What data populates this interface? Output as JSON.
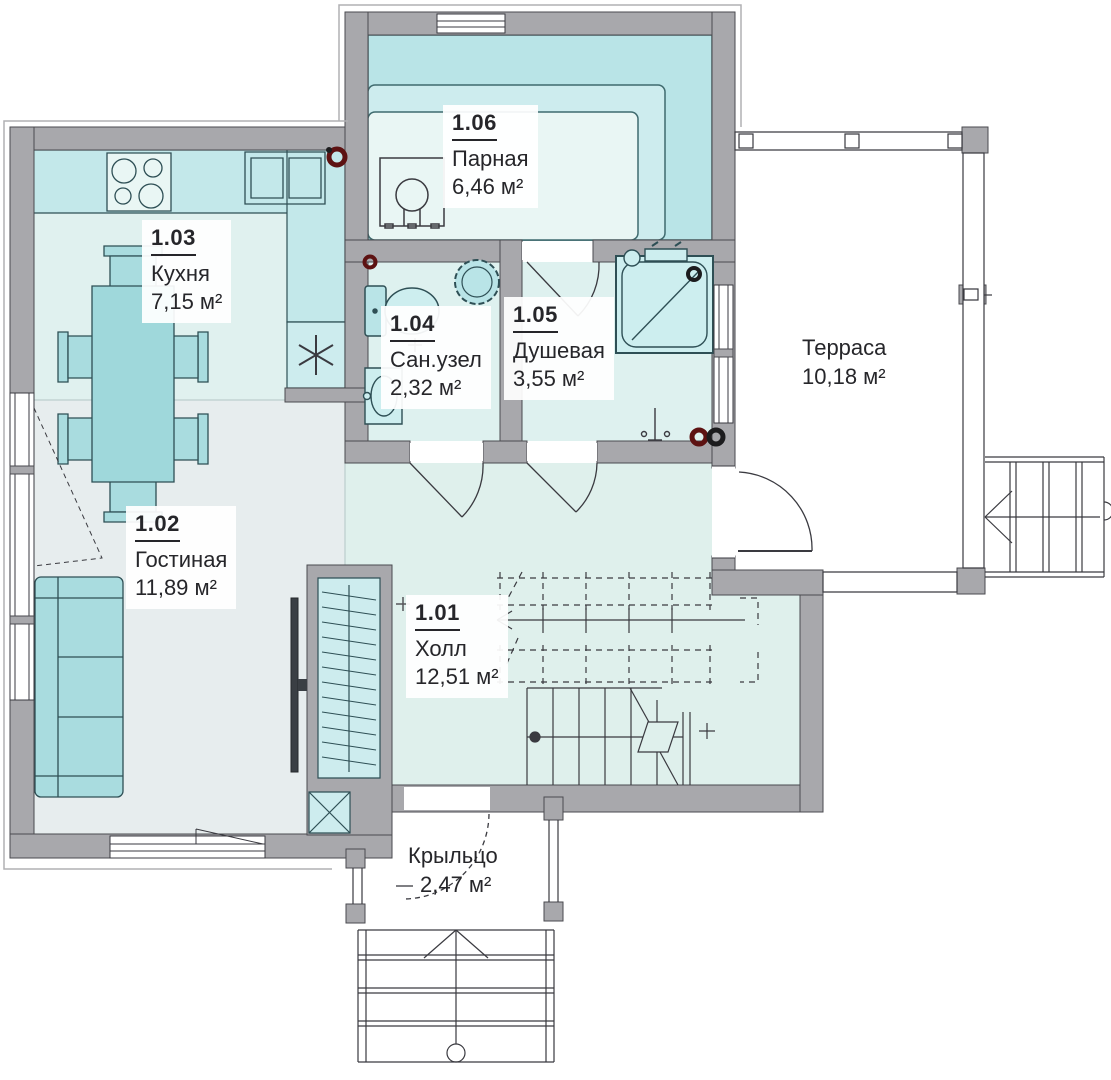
{
  "plan_type": "floor-plan",
  "rooms": [
    {
      "number": "1.06",
      "name": "Парная",
      "area": "6,46 м²"
    },
    {
      "number": "1.03",
      "name": "Кухня",
      "area": "7,15 м²"
    },
    {
      "number": "1.04",
      "name": "Сан.узел",
      "area": "2,32 м²"
    },
    {
      "number": "1.05",
      "name": "Душевая",
      "area": "3,55 м²"
    },
    {
      "number": "1.02",
      "name": "Гостиная",
      "area": "11,89 м²"
    },
    {
      "number": "1.01",
      "name": "Холл",
      "area": "12,51 м²"
    },
    {
      "number": "",
      "name": "Терраса",
      "area": "10,18 м²"
    },
    {
      "number": "",
      "name": "Крыльцо",
      "area": "2,47 м²"
    }
  ],
  "icons": {
    "fridge_star": "snowflake-asterisk",
    "riser_red": "water-riser",
    "riser_black": "sewer-riser",
    "anchor_cross": "plus-mark"
  },
  "colors": {
    "wall": "#a8a8ac",
    "wallline": "#4a4a4f",
    "floorkitchen": "#e0f1ef",
    "floorliving": "#e7edee",
    "floorhall": "#dff0ec",
    "floorbath": "#def1ef",
    "bench1": "#b9e4e7",
    "bench2": "#cdecee",
    "bench3": "#e9f6f4",
    "counter": "#c3e8ea",
    "furniture": "#a9dcdf",
    "furniture2": "#cdeeef",
    "furnline": "#2e4f55",
    "thinline": "#3a3a40",
    "red": "#5d1212",
    "black": "#1c1c1e"
  }
}
